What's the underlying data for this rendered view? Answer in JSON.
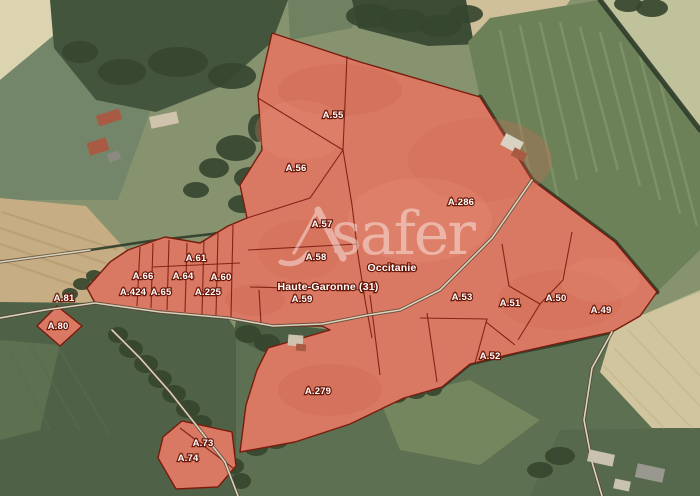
{
  "map": {
    "watermark": {
      "text": "safer",
      "x": 331,
      "y": 254,
      "size": 60,
      "opacity": 0.42,
      "color": "#ffffff",
      "logo_strokes": [
        {
          "d": "M318,210 L343,258",
          "w": 7
        },
        {
          "d": "M318,210 L294,253",
          "w": 3.2
        },
        {
          "d": "M281,262 Q297,268 308,253",
          "w": 5
        }
      ]
    },
    "admin_labels": [
      {
        "text": "Occitanie",
        "x": 392,
        "y": 271,
        "size": 10.5
      },
      {
        "text": "Haute-Garonne (31)",
        "x": 328,
        "y": 290,
        "size": 10.5
      }
    ],
    "parcel_labels": [
      {
        "text": "A.55",
        "x": 333,
        "y": 118
      },
      {
        "text": "A.56",
        "x": 296,
        "y": 171
      },
      {
        "text": "A.57",
        "x": 322,
        "y": 227
      },
      {
        "text": "A.286",
        "x": 461,
        "y": 205
      },
      {
        "text": "A.58",
        "x": 316,
        "y": 260
      },
      {
        "text": "A.61",
        "x": 196,
        "y": 261
      },
      {
        "text": "A.66",
        "x": 143,
        "y": 279
      },
      {
        "text": "A.64",
        "x": 183,
        "y": 279
      },
      {
        "text": "A.60",
        "x": 221,
        "y": 280
      },
      {
        "text": "A.424",
        "x": 133,
        "y": 295
      },
      {
        "text": "A.65",
        "x": 161,
        "y": 295
      },
      {
        "text": "A.225",
        "x": 208,
        "y": 295
      },
      {
        "text": "A.81",
        "x": 64,
        "y": 301
      },
      {
        "text": "A.59",
        "x": 302,
        "y": 302
      },
      {
        "text": "A.53",
        "x": 462,
        "y": 300
      },
      {
        "text": "A.51",
        "x": 510,
        "y": 306
      },
      {
        "text": "A.50",
        "x": 556,
        "y": 301
      },
      {
        "text": "A.49",
        "x": 601,
        "y": 313
      },
      {
        "text": "A.80",
        "x": 58,
        "y": 329
      },
      {
        "text": "A.52",
        "x": 490,
        "y": 359
      },
      {
        "text": "A.279",
        "x": 318,
        "y": 394
      },
      {
        "text": "A.73",
        "x": 203,
        "y": 446
      },
      {
        "text": "A.74",
        "x": 188,
        "y": 461
      }
    ],
    "colors": {
      "base": "#87926f",
      "parcel_fill": "#da7963",
      "parcel_stroke": "#7a1b0d",
      "boundary": "#7a1b0d",
      "label_fill": "#ffffff",
      "label_halo": "#6b1708",
      "road_casing": "#54432f",
      "road_center": "#d9d3bf",
      "hedge": "#2f3e2a",
      "tree": "#36462f"
    },
    "parcels": {
      "main": "272,33 360,62 480,97 532,180 615,242 657,292 640,316 612,332 560,343 520,352 470,364 442,387 404,398 350,424 295,442 240,452 246,405 257,370 268,348 330,330 322,326 273,326 228,318 160,312 95,303 87,288 110,262 128,250 165,237 200,243 228,226 247,218 240,185 262,150 258,95",
      "a80": "57,306 82,326 60,346 37,326",
      "a73_74": "182,421 232,432 236,466 218,487 176,489 158,458 163,437"
    },
    "boundaries": [
      "347,56 343,150",
      "343,150 258,98",
      "247,218 310,198 343,150",
      "343,150 352,205 358,255 365,300 372,338",
      "248,250 358,244",
      "250,287 365,290",
      "259,290 261,324",
      "370,295 380,375",
      "427,313 437,382",
      "140,247 137,306",
      "153,243 151,308",
      "169,240 167,310",
      "187,243 185,312",
      "204,240 202,314",
      "218,233 216,315",
      "233,225 231,317",
      "153,267 240,263",
      "509,286 540,304 563,280",
      "540,304 518,340",
      "509,286 502,244",
      "563,280 572,232",
      "420,318 487,319 475,363",
      "486,322 515,345",
      "180,428 233,468"
    ],
    "background": {
      "fields": [
        {
          "name": "field-top-left-pale",
          "points": "0,0 90,0 45,50 0,80",
          "fill": "#dcd3b0"
        },
        {
          "name": "field-left-green",
          "points": "0,80 60,30 120,60 150,112 118,200 0,200",
          "fill": "#74866a"
        },
        {
          "name": "field-midleft-tan",
          "points": "0,198 86,206 126,250 94,302 0,314",
          "fill": "#c6ad84"
        },
        {
          "name": "forest-top",
          "points": "50,0 288,0 272,42 222,86 156,112 96,100 54,48",
          "fill": "#44553d"
        },
        {
          "name": "field-top-mid",
          "points": "288,0 362,0 352,28 290,40",
          "fill": "#6f8160"
        },
        {
          "name": "trees-top-strip",
          "points": "352,0 472,0 482,44 428,46 358,28",
          "fill": "#3c4c35"
        },
        {
          "name": "field-top-right-tan",
          "points": "466,0 570,0 520,78 474,44",
          "fill": "#cfc09a"
        },
        {
          "name": "field-ne-green",
          "points": "490,18 600,0 700,130 700,250 657,292 615,242 532,180 480,97 468,42",
          "fill": "#6d8159"
        },
        {
          "name": "field-ne-corner",
          "points": "600,0 700,0 700,130",
          "fill": "#c0c29c"
        },
        {
          "name": "field-right-strip",
          "points": "640,316 700,290 700,330 664,330",
          "fill": "#b8bd92"
        },
        {
          "name": "field-bottom-left",
          "points": "0,302 95,303 228,318 236,330 236,496 0,496",
          "fill": "#4f6147"
        },
        {
          "name": "field-bottom-left-pale",
          "points": "0,340 60,345 40,430 0,440",
          "fill": "#5d7050"
        },
        {
          "name": "field-bottom-mid",
          "points": "236,330 700,330 700,496 236,496",
          "fill": "#5d7051"
        },
        {
          "name": "field-bottom-mid-pale",
          "points": "380,400 470,380 540,420 480,465 400,450",
          "fill": "#74865e"
        },
        {
          "name": "field-bottom-right-tan",
          "points": "612,332 640,316 700,292 700,428 652,428 600,372",
          "fill": "#d0c59e"
        },
        {
          "name": "field-bottom-right-green",
          "points": "560,430 700,428 700,496 530,496",
          "fill": "#57694c"
        },
        {
          "name": "notch-green",
          "points": "236,320 292,325 332,330 340,352 320,366 284,360 250,346 234,334",
          "fill": "#4b5e44"
        }
      ],
      "texture_groups": [
        {
          "color": "#8ba272",
          "w": 2.5,
          "op": 0.5,
          "lines": [
            [
              500,
              30,
              540,
              222
            ],
            [
              520,
              25,
              558,
              198
            ],
            [
              540,
              22,
              577,
              180
            ],
            [
              560,
              22,
              597,
              172
            ],
            [
              580,
              27,
              618,
              170
            ],
            [
              600,
              32,
              640,
              186
            ],
            [
              620,
              42,
              660,
              200
            ],
            [
              640,
              56,
              680,
              214
            ],
            [
              658,
              74,
              697,
              226
            ]
          ]
        },
        {
          "color": "#b1976e",
          "w": 2,
          "op": 0.6,
          "lines": [
            [
              2,
              212,
              118,
              250
            ],
            [
              0,
              228,
              108,
              264
            ],
            [
              0,
              244,
              100,
              278
            ],
            [
              0,
              260,
              94,
              292
            ]
          ]
        },
        {
          "color": "#c3b48c",
          "w": 2,
          "op": 0.5,
          "lines": [
            [
              648,
              320,
              700,
              376
            ],
            [
              628,
              330,
              700,
              406
            ],
            [
              614,
              348,
              692,
              428
            ],
            [
              604,
              366,
              664,
              428
            ]
          ]
        },
        {
          "color": "#5a6c4f",
          "w": 2,
          "op": 0.5,
          "lines": [
            [
              10,
              350,
              50,
              430
            ],
            [
              30,
              345,
              80,
              430
            ],
            [
              55,
              342,
              110,
              435
            ]
          ]
        }
      ],
      "hedges": [
        {
          "points": "480,97 532,180 615,242 657,292",
          "w": 5
        },
        {
          "points": "600,0 700,130",
          "w": 5
        },
        {
          "points": "612,332 560,344 520,352 470,364 442,387",
          "w": 3.5
        },
        {
          "points": "90,250 150,241 212,234 252,226",
          "w": 2.5
        }
      ],
      "trees": [
        [
          118,
          335,
          10,
          8
        ],
        [
          131,
          349,
          12,
          9
        ],
        [
          146,
          364,
          12,
          9
        ],
        [
          160,
          379,
          12,
          9
        ],
        [
          174,
          394,
          12,
          9
        ],
        [
          188,
          409,
          12,
          9
        ],
        [
          201,
          423,
          11,
          8
        ],
        [
          213,
          437,
          11,
          8
        ],
        [
          224,
          451,
          11,
          8
        ],
        [
          234,
          466,
          10,
          8
        ],
        [
          241,
          481,
          10,
          8
        ],
        [
          248,
          334,
          13,
          9
        ],
        [
          267,
          343,
          13,
          9
        ],
        [
          286,
          351,
          12,
          8
        ],
        [
          305,
          353,
          11,
          8
        ],
        [
          321,
          344,
          9,
          7
        ],
        [
          256,
          448,
          12,
          8
        ],
        [
          276,
          441,
          12,
          8
        ],
        [
          296,
          433,
          12,
          8
        ],
        [
          316,
          425,
          12,
          8
        ],
        [
          336,
          417,
          12,
          8
        ],
        [
          356,
          409,
          12,
          8
        ],
        [
          376,
          401,
          11,
          8
        ],
        [
          396,
          396,
          11,
          7
        ],
        [
          416,
          392,
          10,
          7
        ],
        [
          433,
          389,
          9,
          7
        ],
        [
          370,
          16,
          24,
          12
        ],
        [
          404,
          21,
          24,
          12
        ],
        [
          440,
          26,
          22,
          11
        ],
        [
          466,
          14,
          17,
          9
        ],
        [
          178,
          62,
          30,
          15
        ],
        [
          232,
          76,
          24,
          13
        ],
        [
          122,
          72,
          24,
          13
        ],
        [
          80,
          52,
          18,
          11
        ],
        [
          236,
          148,
          20,
          13
        ],
        [
          250,
          178,
          16,
          11
        ],
        [
          242,
          204,
          14,
          9
        ],
        [
          214,
          168,
          15,
          10
        ],
        [
          196,
          190,
          13,
          8
        ],
        [
          258,
          128,
          10,
          14
        ],
        [
          254,
          226,
          10,
          8
        ],
        [
          82,
          284,
          9,
          6
        ],
        [
          70,
          294,
          8,
          6
        ],
        [
          94,
          276,
          8,
          6
        ],
        [
          560,
          456,
          15,
          9
        ],
        [
          540,
          470,
          13,
          8
        ],
        [
          652,
          8,
          16,
          9
        ],
        [
          628,
          4,
          14,
          8
        ]
      ],
      "roads": [
        {
          "points": "0,318 45,310 95,303 160,312 228,318 273,326 322,324 368,315 400,310 440,290 492,238 532,180"
        },
        {
          "points": "612,332 592,368 584,420 592,462 602,496"
        },
        {
          "points": "112,330 140,358 170,392 200,430 225,462 238,496"
        },
        {
          "points": "0,262 45,256 90,250"
        }
      ],
      "buildings": [
        {
          "x": 97,
          "y": 112,
          "w": 24,
          "h": 11,
          "rot": -18,
          "fill": "#a85a43"
        },
        {
          "x": 150,
          "y": 114,
          "w": 28,
          "h": 12,
          "rot": -12,
          "fill": "#cfc3ae"
        },
        {
          "x": 88,
          "y": 140,
          "w": 20,
          "h": 13,
          "rot": -18,
          "fill": "#a85a43"
        },
        {
          "x": 108,
          "y": 152,
          "w": 12,
          "h": 9,
          "rot": -18,
          "fill": "#8a8a80"
        },
        {
          "x": 502,
          "y": 137,
          "w": 20,
          "h": 13,
          "rot": 28,
          "fill": "#d8d2c2"
        },
        {
          "x": 512,
          "y": 150,
          "w": 14,
          "h": 9,
          "rot": 28,
          "fill": "#a85a43"
        },
        {
          "x": 288,
          "y": 335,
          "w": 15,
          "h": 11,
          "rot": 5,
          "fill": "#cdc2ae"
        },
        {
          "x": 296,
          "y": 344,
          "w": 10,
          "h": 7,
          "rot": 5,
          "fill": "#a85a43"
        },
        {
          "x": 588,
          "y": 452,
          "w": 26,
          "h": 12,
          "rot": 12,
          "fill": "#c9c2b1"
        },
        {
          "x": 636,
          "y": 466,
          "w": 28,
          "h": 14,
          "rot": 12,
          "fill": "#99988e"
        },
        {
          "x": 614,
          "y": 480,
          "w": 16,
          "h": 10,
          "rot": 12,
          "fill": "#c9c2b1"
        }
      ],
      "red_shading": [
        [
          340,
          90,
          62,
          26,
          "#cc6751",
          0.35
        ],
        [
          480,
          160,
          72,
          42,
          "#cf6953",
          0.3
        ],
        [
          300,
          250,
          42,
          30,
          "#cc6751",
          0.28
        ],
        [
          560,
          300,
          62,
          30,
          "#cc6751",
          0.25
        ],
        [
          330,
          390,
          52,
          26,
          "#c96550",
          0.3
        ],
        [
          420,
          220,
          72,
          42,
          "#e79179",
          0.28
        ],
        [
          300,
          130,
          45,
          30,
          "#e79179",
          0.25
        ],
        [
          600,
          280,
          40,
          22,
          "#e79179",
          0.25
        ],
        [
          255,
          300,
          30,
          16,
          "#c96550",
          0.3
        ]
      ]
    }
  }
}
